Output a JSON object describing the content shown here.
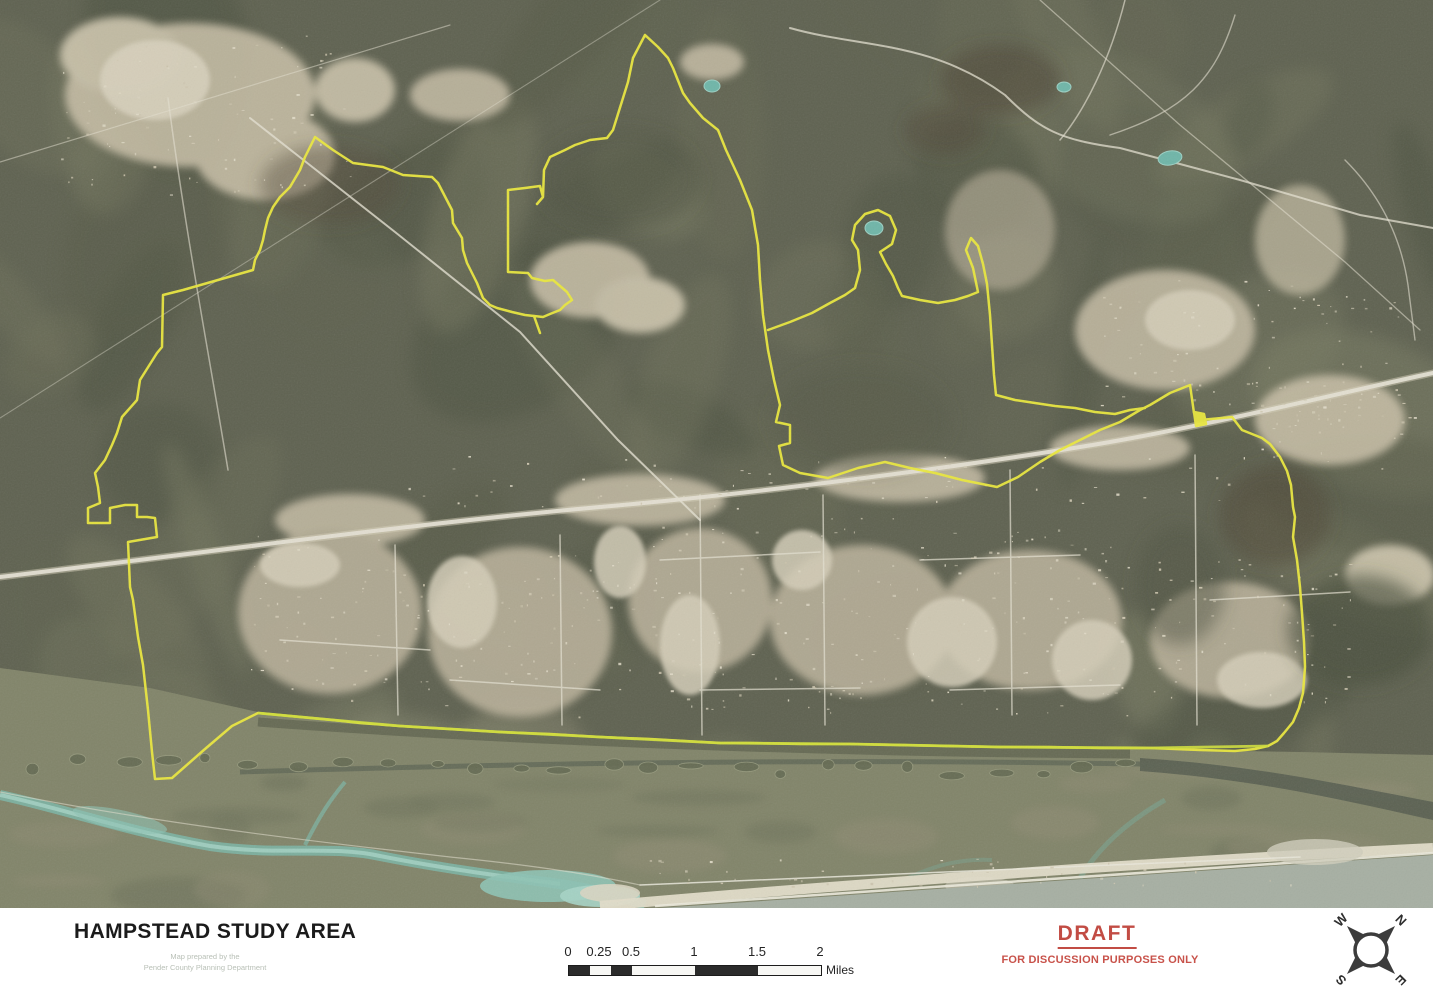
{
  "map": {
    "name": "Hampstead study area aerial map",
    "boundary_color": "#efec3c",
    "boundary_south_color": "#d3e23a"
  },
  "footer": {
    "title": "HAMPSTEAD STUDY AREA",
    "attribution": [
      "Map prepared by the",
      "Pender County Planning Department"
    ],
    "draft_label": "DRAFT",
    "draft_note": "FOR DISCUSSION PURPOSES ONLY"
  },
  "scale_bar": {
    "labels": [
      "0",
      "0.25",
      "0.5",
      "1",
      "1.5",
      "2"
    ],
    "unit": "Miles"
  },
  "compass": {
    "north": "N",
    "east": "E",
    "south": "S",
    "west": "W"
  },
  "colors": {
    "draft_red": "#c24c44",
    "boundary_yellow": "#efec3c",
    "forest_olive": "#5e6150",
    "development_tan": "#c8bfa6",
    "water_teal": "#7db8a9",
    "ocean_gray": "#a9b2a6",
    "beach_sand": "#e7e2cf"
  }
}
